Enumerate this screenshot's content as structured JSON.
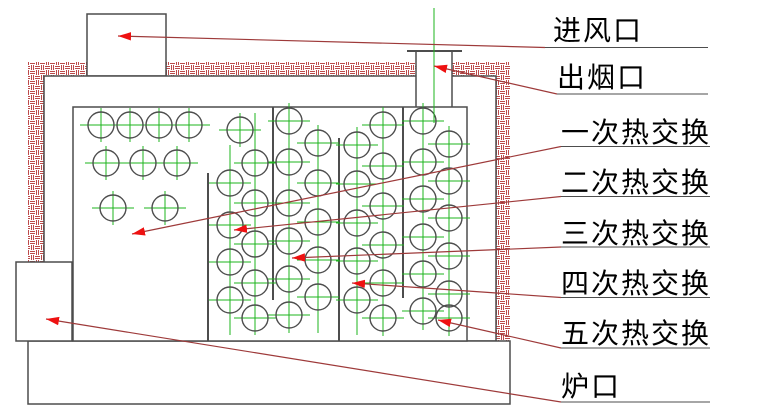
{
  "colors": {
    "background": "#ffffff",
    "structure": "#4d4d4d",
    "hatch": "#bc4a4a",
    "centerline_green": "#1eb41e",
    "leader": "#9e3a3a",
    "arrowhead": "#ee1111",
    "underline": "#4d4d4d",
    "text": "#000000"
  },
  "labels": [
    {
      "id": "air-inlet",
      "text": "进风口",
      "x": 553,
      "y": 17,
      "underline": {
        "x1": 545,
        "x2": 708,
        "y": 47.5
      },
      "leader": {
        "x1": 545,
        "y1": 47.5,
        "x2": 118,
        "y2": 36
      }
    },
    {
      "id": "smoke-outlet",
      "text": "出烟口",
      "x": 557,
      "y": 64,
      "underline": {
        "x1": 557,
        "x2": 708,
        "y": 94
      },
      "leader": {
        "x1": 557,
        "y1": 94,
        "x2": 434,
        "y2": 66
      }
    },
    {
      "id": "heat-exchange-1",
      "text": "一次热交换",
      "x": 561,
      "y": 119,
      "underline": {
        "x1": 561,
        "x2": 710,
        "y": 146.5
      },
      "leader": {
        "x1": 561,
        "y1": 146.5,
        "x2": 132,
        "y2": 234
      }
    },
    {
      "id": "heat-exchange-2",
      "text": "二次热交换",
      "x": 561,
      "y": 169,
      "underline": {
        "x1": 561,
        "x2": 710,
        "y": 196.5
      },
      "leader": {
        "x1": 561,
        "y1": 196.5,
        "x2": 234,
        "y2": 230
      }
    },
    {
      "id": "heat-exchange-3",
      "text": "三次热交换",
      "x": 561,
      "y": 220,
      "underline": {
        "x1": 561,
        "x2": 710,
        "y": 247
      },
      "leader": {
        "x1": 561,
        "y1": 247,
        "x2": 292,
        "y2": 258
      }
    },
    {
      "id": "heat-exchange-4",
      "text": "四次热交换",
      "x": 561,
      "y": 270,
      "underline": {
        "x1": 561,
        "x2": 710,
        "y": 297.5
      },
      "leader": {
        "x1": 561,
        "y1": 297.5,
        "x2": 352,
        "y2": 283
      }
    },
    {
      "id": "heat-exchange-5",
      "text": "五次热交换",
      "x": 561,
      "y": 320,
      "underline": {
        "x1": 561,
        "x2": 710,
        "y": 348
      },
      "leader": {
        "x1": 561,
        "y1": 348,
        "x2": 438,
        "y2": 320
      }
    },
    {
      "id": "furnace-door",
      "text": "炉口",
      "x": 561,
      "y": 373,
      "underline": {
        "x1": 561,
        "x2": 710,
        "y": 402
      },
      "leader": {
        "x1": 561,
        "y1": 402,
        "x2": 46,
        "y2": 319
      }
    }
  ],
  "structure": {
    "walls": [
      {
        "name": "top-wall-left",
        "x": 28,
        "y": 62,
        "w": 59,
        "h": 14
      },
      {
        "name": "top-wall-middle",
        "x": 166,
        "y": 62,
        "w": 250,
        "h": 14
      },
      {
        "name": "top-wall-right",
        "x": 452,
        "y": 62,
        "w": 58,
        "h": 14
      },
      {
        "name": "left-wall",
        "x": 28,
        "y": 75,
        "w": 16,
        "h": 188
      },
      {
        "name": "right-wall",
        "x": 494,
        "y": 75,
        "w": 16,
        "h": 266
      }
    ],
    "boxes": [
      {
        "name": "air-inlet-box",
        "x": 87,
        "y": 14,
        "w": 79,
        "h": 62
      },
      {
        "name": "interior",
        "x": 44,
        "y": 76,
        "w": 452,
        "h": 265
      },
      {
        "name": "base",
        "x": 28,
        "y": 341,
        "w": 482,
        "h": 63
      },
      {
        "name": "furnace-door-box",
        "x": 16,
        "y": 262,
        "w": 56,
        "h": 79
      }
    ],
    "pipe": {
      "x": 416,
      "y": 51,
      "w": 36,
      "h": 57,
      "flange": {
        "x1": 407,
        "x2": 462,
        "y": 51
      },
      "centerline": {
        "x": 434,
        "y1": 8,
        "y2": 123
      }
    },
    "tube_chamber": {
      "name": "tube-chamber",
      "x": 73,
      "y": 107,
      "w": 394,
      "h": 234
    },
    "dividers": [
      {
        "x": 208,
        "y1": 173,
        "y2": 341
      },
      {
        "x": 273,
        "y1": 107,
        "y2": 300
      },
      {
        "x": 339,
        "y1": 138,
        "y2": 341
      },
      {
        "x": 403,
        "y1": 107,
        "y2": 298
      }
    ],
    "green_columns": [
      {
        "x": 230,
        "y1": 145,
        "y2": 335
      },
      {
        "x": 255,
        "y1": 113,
        "y2": 335
      },
      {
        "x": 289,
        "y1": 103,
        "y2": 333
      },
      {
        "x": 318,
        "y1": 125,
        "y2": 333
      },
      {
        "x": 357,
        "y1": 127,
        "y2": 335
      },
      {
        "x": 383,
        "y1": 107,
        "y2": 336
      },
      {
        "x": 423,
        "y1": 103,
        "y2": 330
      },
      {
        "x": 449,
        "y1": 126,
        "y2": 336
      }
    ],
    "tube_radius": 13,
    "tube_sections": [
      {
        "name": "firebox-tubes",
        "tubes": [
          [
            101,
            125
          ],
          [
            130,
            125
          ],
          [
            159,
            125
          ],
          [
            189,
            125
          ],
          [
            106,
            163
          ],
          [
            143,
            163
          ],
          [
            177,
            163
          ],
          [
            113,
            208
          ],
          [
            165,
            208
          ]
        ]
      },
      {
        "name": "pass-1-tubes",
        "tubes": [
          [
            240,
            130
          ],
          [
            255,
            163
          ],
          [
            230,
            183
          ],
          [
            255,
            203
          ],
          [
            230,
            225
          ],
          [
            255,
            244
          ],
          [
            230,
            262
          ],
          [
            255,
            283
          ],
          [
            230,
            300
          ],
          [
            255,
            318
          ]
        ]
      },
      {
        "name": "pass-2-tubes",
        "tubes": [
          [
            289,
            121
          ],
          [
            318,
            143
          ],
          [
            289,
            162
          ],
          [
            318,
            183
          ],
          [
            289,
            203
          ],
          [
            318,
            222
          ],
          [
            289,
            241
          ],
          [
            318,
            260
          ],
          [
            289,
            279
          ],
          [
            318,
            297
          ],
          [
            289,
            315
          ]
        ]
      },
      {
        "name": "pass-3-tubes",
        "tubes": [
          [
            383,
            125
          ],
          [
            357,
            145
          ],
          [
            383,
            166
          ],
          [
            357,
            184
          ],
          [
            383,
            206
          ],
          [
            357,
            223
          ],
          [
            383,
            245
          ],
          [
            357,
            261
          ],
          [
            383,
            283
          ],
          [
            357,
            300
          ],
          [
            383,
            318
          ]
        ]
      },
      {
        "name": "pass-4-tubes",
        "tubes": [
          [
            423,
            121
          ],
          [
            449,
            144
          ],
          [
            423,
            162
          ],
          [
            449,
            181
          ],
          [
            423,
            199
          ],
          [
            449,
            218
          ],
          [
            423,
            237
          ],
          [
            449,
            256
          ],
          [
            423,
            274
          ],
          [
            449,
            294
          ],
          [
            423,
            311
          ],
          [
            449,
            318
          ]
        ]
      }
    ]
  }
}
